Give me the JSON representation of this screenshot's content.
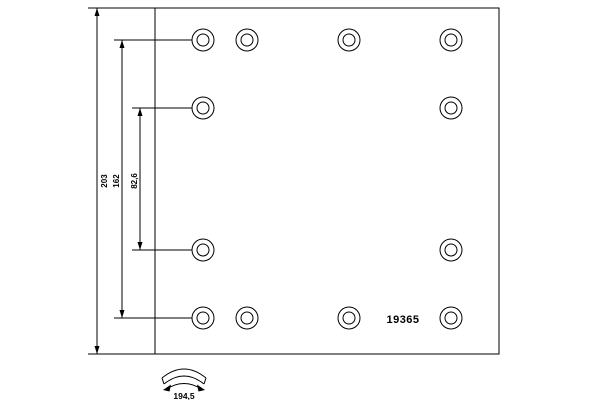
{
  "page": {
    "background_color": "#ffffff",
    "line_color": "#000000"
  },
  "drawing": {
    "part_number": "19365",
    "plate": {
      "x": 155,
      "y": 8,
      "width": 344,
      "height": 346
    },
    "holes": {
      "outer_radius": 11,
      "inner_radius": 6,
      "rows": [
        {
          "y": 40,
          "xs": [
            203,
            247,
            349,
            451
          ]
        },
        {
          "y": 108,
          "xs": [
            203,
            451
          ]
        },
        {
          "y": 250,
          "xs": [
            203,
            451
          ]
        },
        {
          "y": 318,
          "xs": [
            203,
            247,
            349,
            451
          ]
        }
      ]
    },
    "dimensions": [
      {
        "label": "203",
        "line_x": 97,
        "y1": 8,
        "y2": 354,
        "label_x": 105,
        "label_y": 181,
        "ext": [
          {
            "y": 8,
            "x1": 88,
            "x2": 155
          },
          {
            "y": 354,
            "x1": 88,
            "x2": 155
          }
        ]
      },
      {
        "label": "162",
        "line_x": 122,
        "y1": 40,
        "y2": 318,
        "label_x": 117,
        "label_y": 181,
        "ext": [
          {
            "y": 40,
            "x1": 114,
            "x2": 192
          },
          {
            "y": 318,
            "x1": 114,
            "x2": 192
          }
        ]
      },
      {
        "label": "82,6",
        "line_x": 140,
        "y1": 108,
        "y2": 250,
        "label_x": 135,
        "label_y": 181,
        "ext": [
          {
            "y": 108,
            "x1": 132,
            "x2": 192
          },
          {
            "y": 250,
            "x1": 132,
            "x2": 192
          }
        ]
      }
    ],
    "arc_detail": {
      "label": "194,5"
    }
  }
}
